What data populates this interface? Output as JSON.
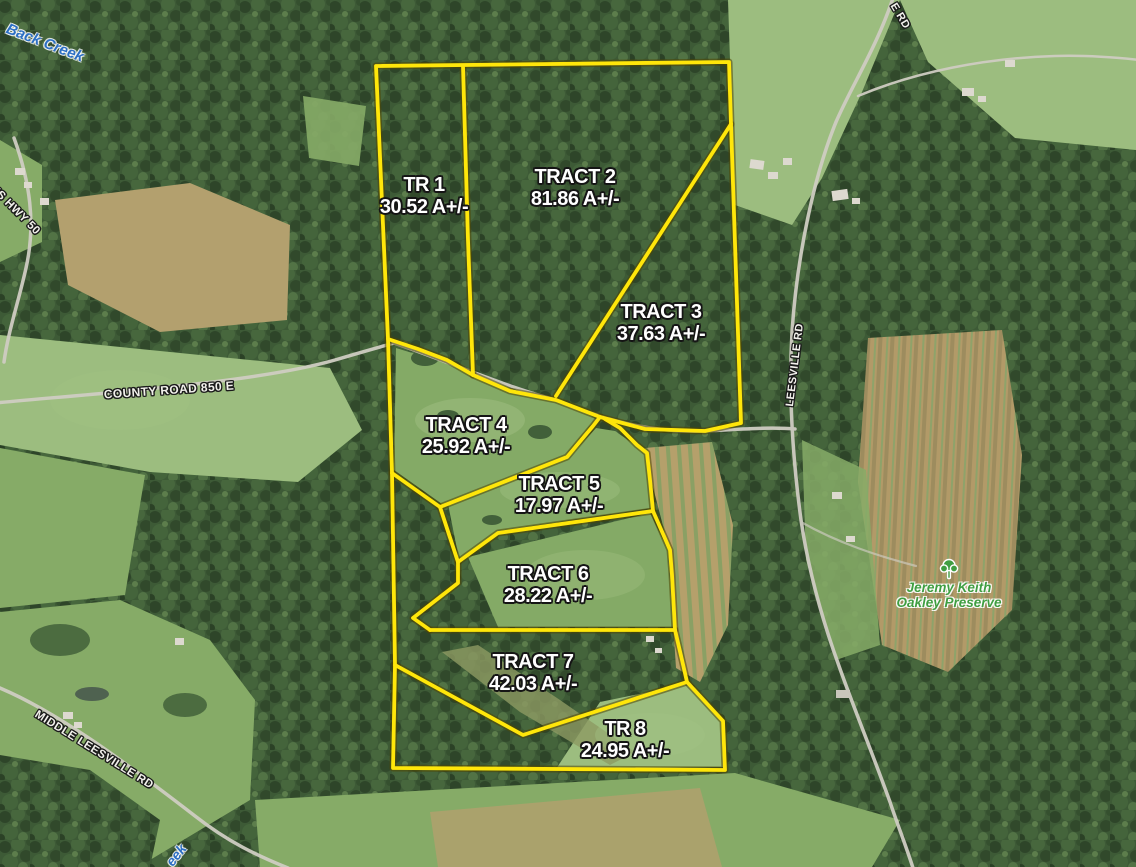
{
  "map": {
    "tracts": [
      {
        "name": "TR 1",
        "acreage": "30.52 A+/-"
      },
      {
        "name": "TRACT 2",
        "acreage": "81.86 A+/-"
      },
      {
        "name": "TRACT 3",
        "acreage": "37.63 A+/-"
      },
      {
        "name": "TRACT 4",
        "acreage": "25.92 A+/-"
      },
      {
        "name": "TRACT 5",
        "acreage": "17.97 A+/-"
      },
      {
        "name": "TRACT 6",
        "acreage": "28.22 A+/-"
      },
      {
        "name": "TRACT 7",
        "acreage": "42.03 A+/-"
      },
      {
        "name": "TR 8",
        "acreage": "24.95 A+/-"
      }
    ],
    "places": {
      "back_creek": "Back Creek",
      "creek_fragment": "eek",
      "us_hwy_50": "US HWY 50",
      "county_road_850e": "COUNTY ROAD 850 E",
      "leesville_rd": "LEESVILLE RD",
      "leesville_rd_fragment": "E RD",
      "middle_leesville_rd": "MIDDLE LEESVILLE RD",
      "preserve_line1": "Jeremy Keith",
      "preserve_line2": "Oakley Preserve"
    },
    "colors": {
      "boundary_yellow": "#ffe60a",
      "creek_label_blue": "#2c6fc4",
      "preserve_label_green": "#3f9e41"
    }
  }
}
